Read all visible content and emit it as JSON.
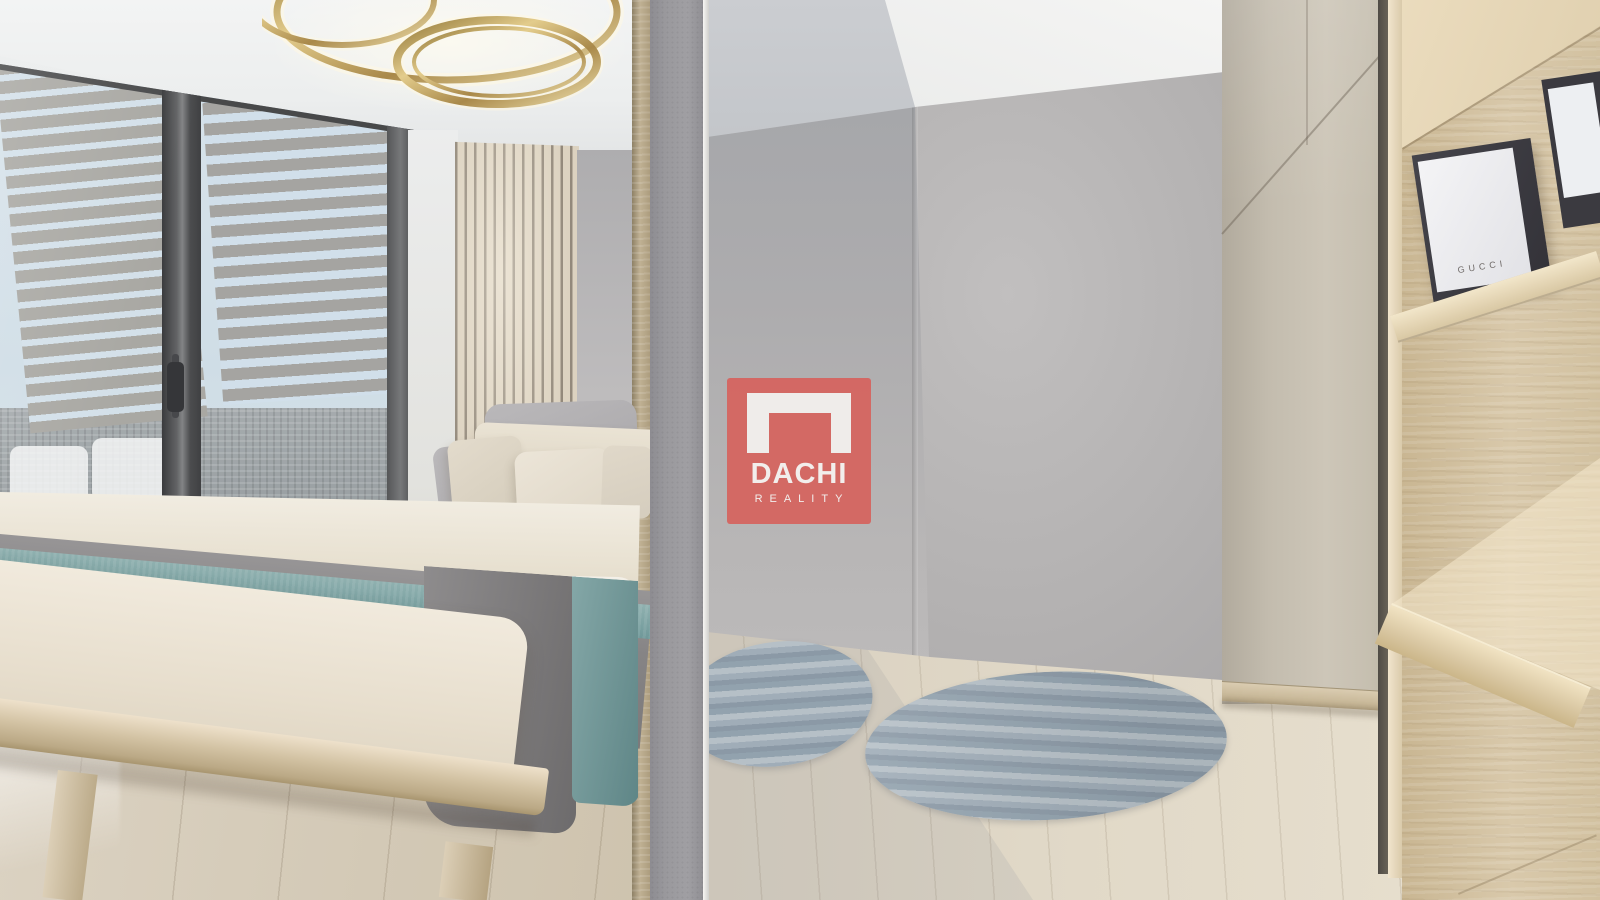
{
  "watermark": {
    "title": "DACHI",
    "subtitle": "REALITY",
    "icon": "door-frame-icon",
    "color": "#D75E59"
  },
  "shelf_box": {
    "brand": "GUCCI"
  },
  "palette": {
    "watermark_red": "#D75E59",
    "watermark_text": "#F2EEEC",
    "ceiling_white": "#F3F4F4",
    "wall_gray": "#B1AFB0",
    "concrete_pillar": "#9A999D",
    "wood_post": "#B3A386",
    "slat_panel_light": "#DCD2C0",
    "slat_panel_dark": "#93897B",
    "floor_wood": "#D8CFBF",
    "bed_linen_cream": "#EAE3D4",
    "pillow_gray": "#B0AEB1",
    "blanket_gray": "#868485",
    "throw_teal": "#7FA5A5",
    "rug_blue_gray": "#9FAEB9",
    "wardrobe_beige": "#C9C2B4",
    "shelf_oak": "#D5C2A2",
    "window_frame_dark": "#3B3B3D",
    "blind_slat": "#A6A3A0",
    "sky": "#D7E4EE",
    "grass_green": "#7E9159",
    "stone_wall_gray": "#9DA2A5",
    "gold_light_ring": "#C9AC66",
    "gucci_box_dark": "#3B3A40",
    "gucci_box_white": "#EFEFF2"
  }
}
